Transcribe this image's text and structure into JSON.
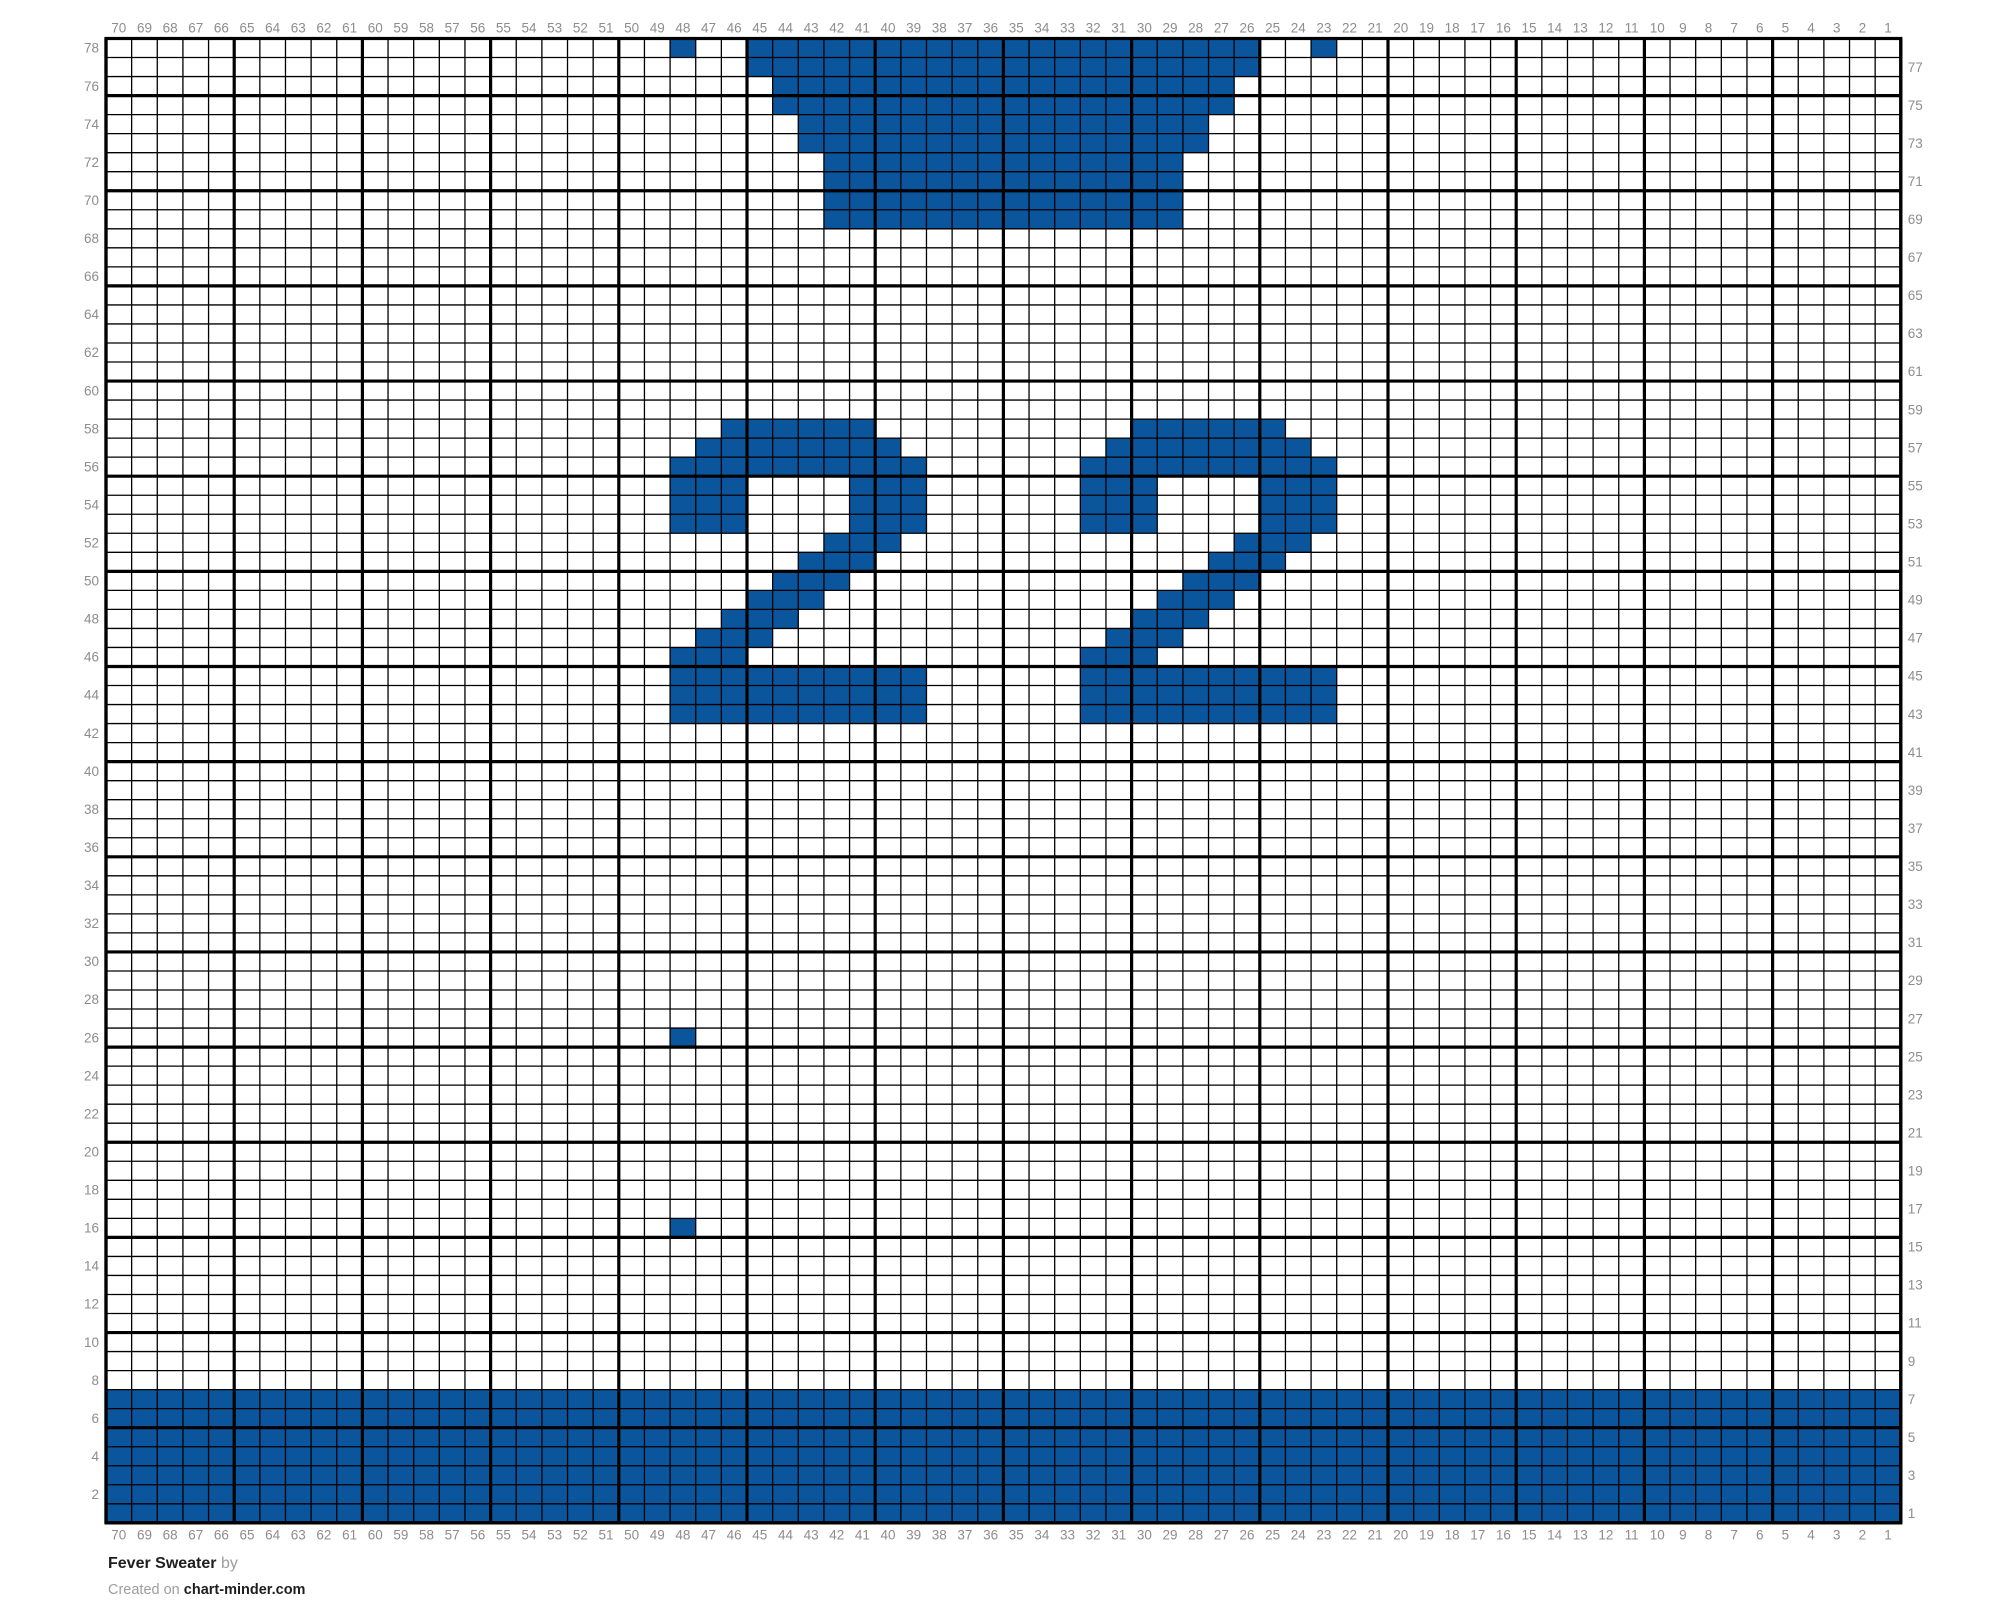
{
  "footer": {
    "title": "Fever Sweater",
    "by_label": "by",
    "created_prefix": "Created on",
    "site": "chart-minder.com"
  },
  "colors": {
    "stitch_fill": "#0b559c",
    "grid_line": "#000000",
    "label_text": "#8d8d8d",
    "footer_dark": "#1e1e1e",
    "footer_muted": "#9e9e9e",
    "background": "#ffffff"
  },
  "grid": {
    "columns": 70,
    "rows": 78,
    "left": 106,
    "top": 38.5,
    "cell_width": 25.64,
    "cell_height": 19.03,
    "bold_every": 5,
    "thin_stroke": 1.3,
    "bold_stroke": 3.2,
    "label_font_size": 13.5,
    "column_labels": [
      70,
      69,
      68,
      67,
      66,
      65,
      64,
      63,
      62,
      61,
      60,
      59,
      58,
      57,
      56,
      55,
      54,
      53,
      52,
      51,
      50,
      49,
      48,
      47,
      46,
      45,
      44,
      43,
      42,
      41,
      40,
      39,
      38,
      37,
      36,
      35,
      34,
      33,
      32,
      31,
      30,
      29,
      28,
      27,
      26,
      25,
      24,
      23,
      22,
      21,
      20,
      19,
      18,
      17,
      16,
      15,
      14,
      13,
      12,
      11,
      10,
      9,
      8,
      7,
      6,
      5,
      4,
      3,
      2,
      1
    ],
    "left_row_labels": [
      78,
      76,
      74,
      72,
      70,
      68,
      66,
      64,
      62,
      60,
      58,
      56,
      54,
      52,
      50,
      48,
      46,
      44,
      42,
      40,
      38,
      36,
      34,
      32,
      30,
      28,
      26,
      24,
      22,
      20,
      18,
      16,
      14,
      12,
      10,
      8,
      6,
      4,
      2
    ],
    "right_row_labels": [
      77,
      75,
      73,
      71,
      69,
      67,
      65,
      63,
      61,
      59,
      57,
      55,
      53,
      51,
      49,
      47,
      45,
      43,
      41,
      39,
      37,
      35,
      33,
      31,
      29,
      27,
      25,
      23,
      21,
      19,
      17,
      15,
      13,
      11,
      9,
      7,
      5,
      3,
      1
    ]
  },
  "chart_data": {
    "type": "heatmap",
    "title": "Fever Sweater",
    "description": "Knitting colorwork chart, 70 stitches wide by 78 rows tall. Columns are numbered 70 (left) down to 1 (right); rows are numbered 78 (top) down to 1 (bottom). Filled runs are [fromColumn, toColumn] inclusive.",
    "grid_on": true,
    "fill_color": "#0b559c",
    "filled_runs_by_row": {
      "78": [
        [
          48,
          48
        ],
        [
          45,
          26
        ],
        [
          23,
          23
        ]
      ],
      "77": [
        [
          45,
          26
        ]
      ],
      "76": [
        [
          44,
          27
        ]
      ],
      "75": [
        [
          44,
          27
        ]
      ],
      "74": [
        [
          43,
          28
        ]
      ],
      "73": [
        [
          43,
          28
        ]
      ],
      "72": [
        [
          42,
          29
        ]
      ],
      "71": [
        [
          42,
          29
        ]
      ],
      "70": [
        [
          42,
          29
        ]
      ],
      "69": [
        [
          42,
          29
        ]
      ],
      "58": [
        [
          46,
          41
        ],
        [
          30,
          25
        ]
      ],
      "57": [
        [
          47,
          40
        ],
        [
          31,
          24
        ]
      ],
      "56": [
        [
          48,
          39
        ],
        [
          32,
          23
        ]
      ],
      "55": [
        [
          48,
          46
        ],
        [
          41,
          39
        ],
        [
          32,
          30
        ],
        [
          25,
          23
        ]
      ],
      "54": [
        [
          48,
          46
        ],
        [
          41,
          39
        ],
        [
          32,
          30
        ],
        [
          25,
          23
        ]
      ],
      "53": [
        [
          48,
          46
        ],
        [
          41,
          39
        ],
        [
          32,
          30
        ],
        [
          25,
          23
        ]
      ],
      "52": [
        [
          42,
          40
        ],
        [
          26,
          24
        ]
      ],
      "51": [
        [
          43,
          41
        ],
        [
          27,
          25
        ]
      ],
      "50": [
        [
          44,
          42
        ],
        [
          28,
          26
        ]
      ],
      "49": [
        [
          45,
          43
        ],
        [
          29,
          27
        ]
      ],
      "48": [
        [
          46,
          44
        ],
        [
          30,
          28
        ]
      ],
      "47": [
        [
          47,
          45
        ],
        [
          31,
          29
        ]
      ],
      "46": [
        [
          48,
          46
        ],
        [
          32,
          30
        ]
      ],
      "45": [
        [
          48,
          39
        ],
        [
          32,
          23
        ]
      ],
      "44": [
        [
          48,
          39
        ],
        [
          32,
          23
        ]
      ],
      "43": [
        [
          48,
          39
        ],
        [
          32,
          23
        ]
      ],
      "26": [
        [
          48,
          48
        ]
      ],
      "16": [
        [
          48,
          48
        ]
      ],
      "7": [
        [
          70,
          1
        ]
      ],
      "6": [
        [
          70,
          1
        ]
      ],
      "5": [
        [
          70,
          1
        ]
      ],
      "4": [
        [
          70,
          1
        ]
      ],
      "3": [
        [
          70,
          1
        ]
      ],
      "2": [
        [
          70,
          1
        ]
      ],
      "1": [
        [
          70,
          1
        ]
      ]
    }
  }
}
